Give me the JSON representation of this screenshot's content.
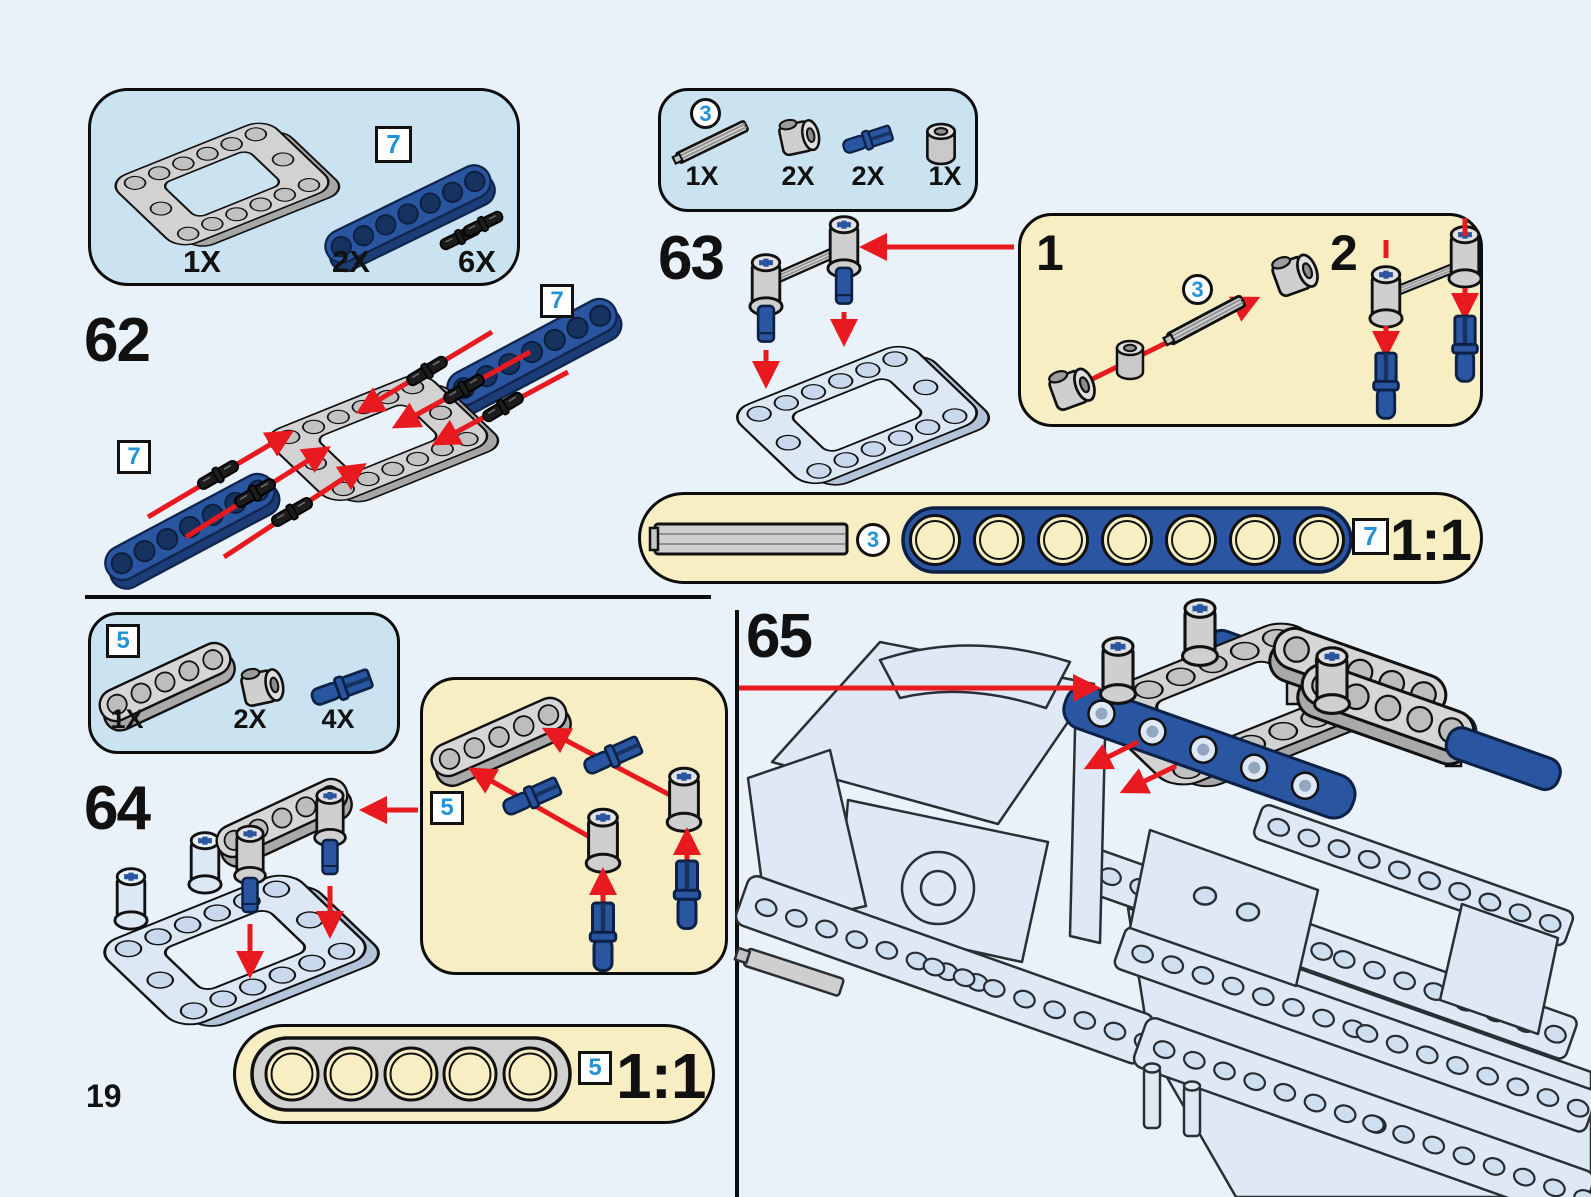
{
  "page_number": "19",
  "colors": {
    "background": "#eaf2f9",
    "parts_panel_blue": "#cbe2f1",
    "callout_panel_yellow": "#f7eec3",
    "lego_blue": "#2a55a0",
    "lego_gray": "#d2d2d2",
    "assembled_pale_blue": "#dfe9f5",
    "arrow_red": "#e8191f",
    "callout_number_blue": "#2492d6",
    "outline_black": "#111111"
  },
  "steps": {
    "62": "62",
    "63": "63",
    "64": "64",
    "65": "65"
  },
  "substeps": {
    "1": "1",
    "2": "2"
  },
  "callouts": {
    "3": "3",
    "5": "5",
    "7": "7"
  },
  "parts_boxes": {
    "box_62": {
      "items": [
        {
          "qty": "1X",
          "part": "technic-frame-5x7-gray"
        },
        {
          "qty": "2X",
          "part": "technic-beam-7-blue",
          "callout": "7"
        },
        {
          "qty": "6X",
          "part": "technic-pin-long-black"
        }
      ]
    },
    "box_63": {
      "items": [
        {
          "qty": "1X",
          "part": "technic-axle-3-gray",
          "callout": "3"
        },
        {
          "qty": "2X",
          "part": "axle-connector-gray"
        },
        {
          "qty": "2X",
          "part": "axle-pin-blue"
        },
        {
          "qty": "1X",
          "part": "bushing-gray"
        }
      ]
    },
    "box_64": {
      "items": [
        {
          "qty": "1X",
          "part": "technic-beam-5-gray",
          "callout": "5"
        },
        {
          "qty": "2X",
          "part": "axle-connector-gray"
        },
        {
          "qty": "4X",
          "part": "axle-pin-blue"
        }
      ]
    }
  },
  "scale_bars": {
    "top": {
      "ratio": "1:1",
      "axle_callout": "3",
      "beam_callout": "7"
    },
    "bottom": {
      "ratio": "1:1",
      "beam_callout": "5"
    }
  }
}
